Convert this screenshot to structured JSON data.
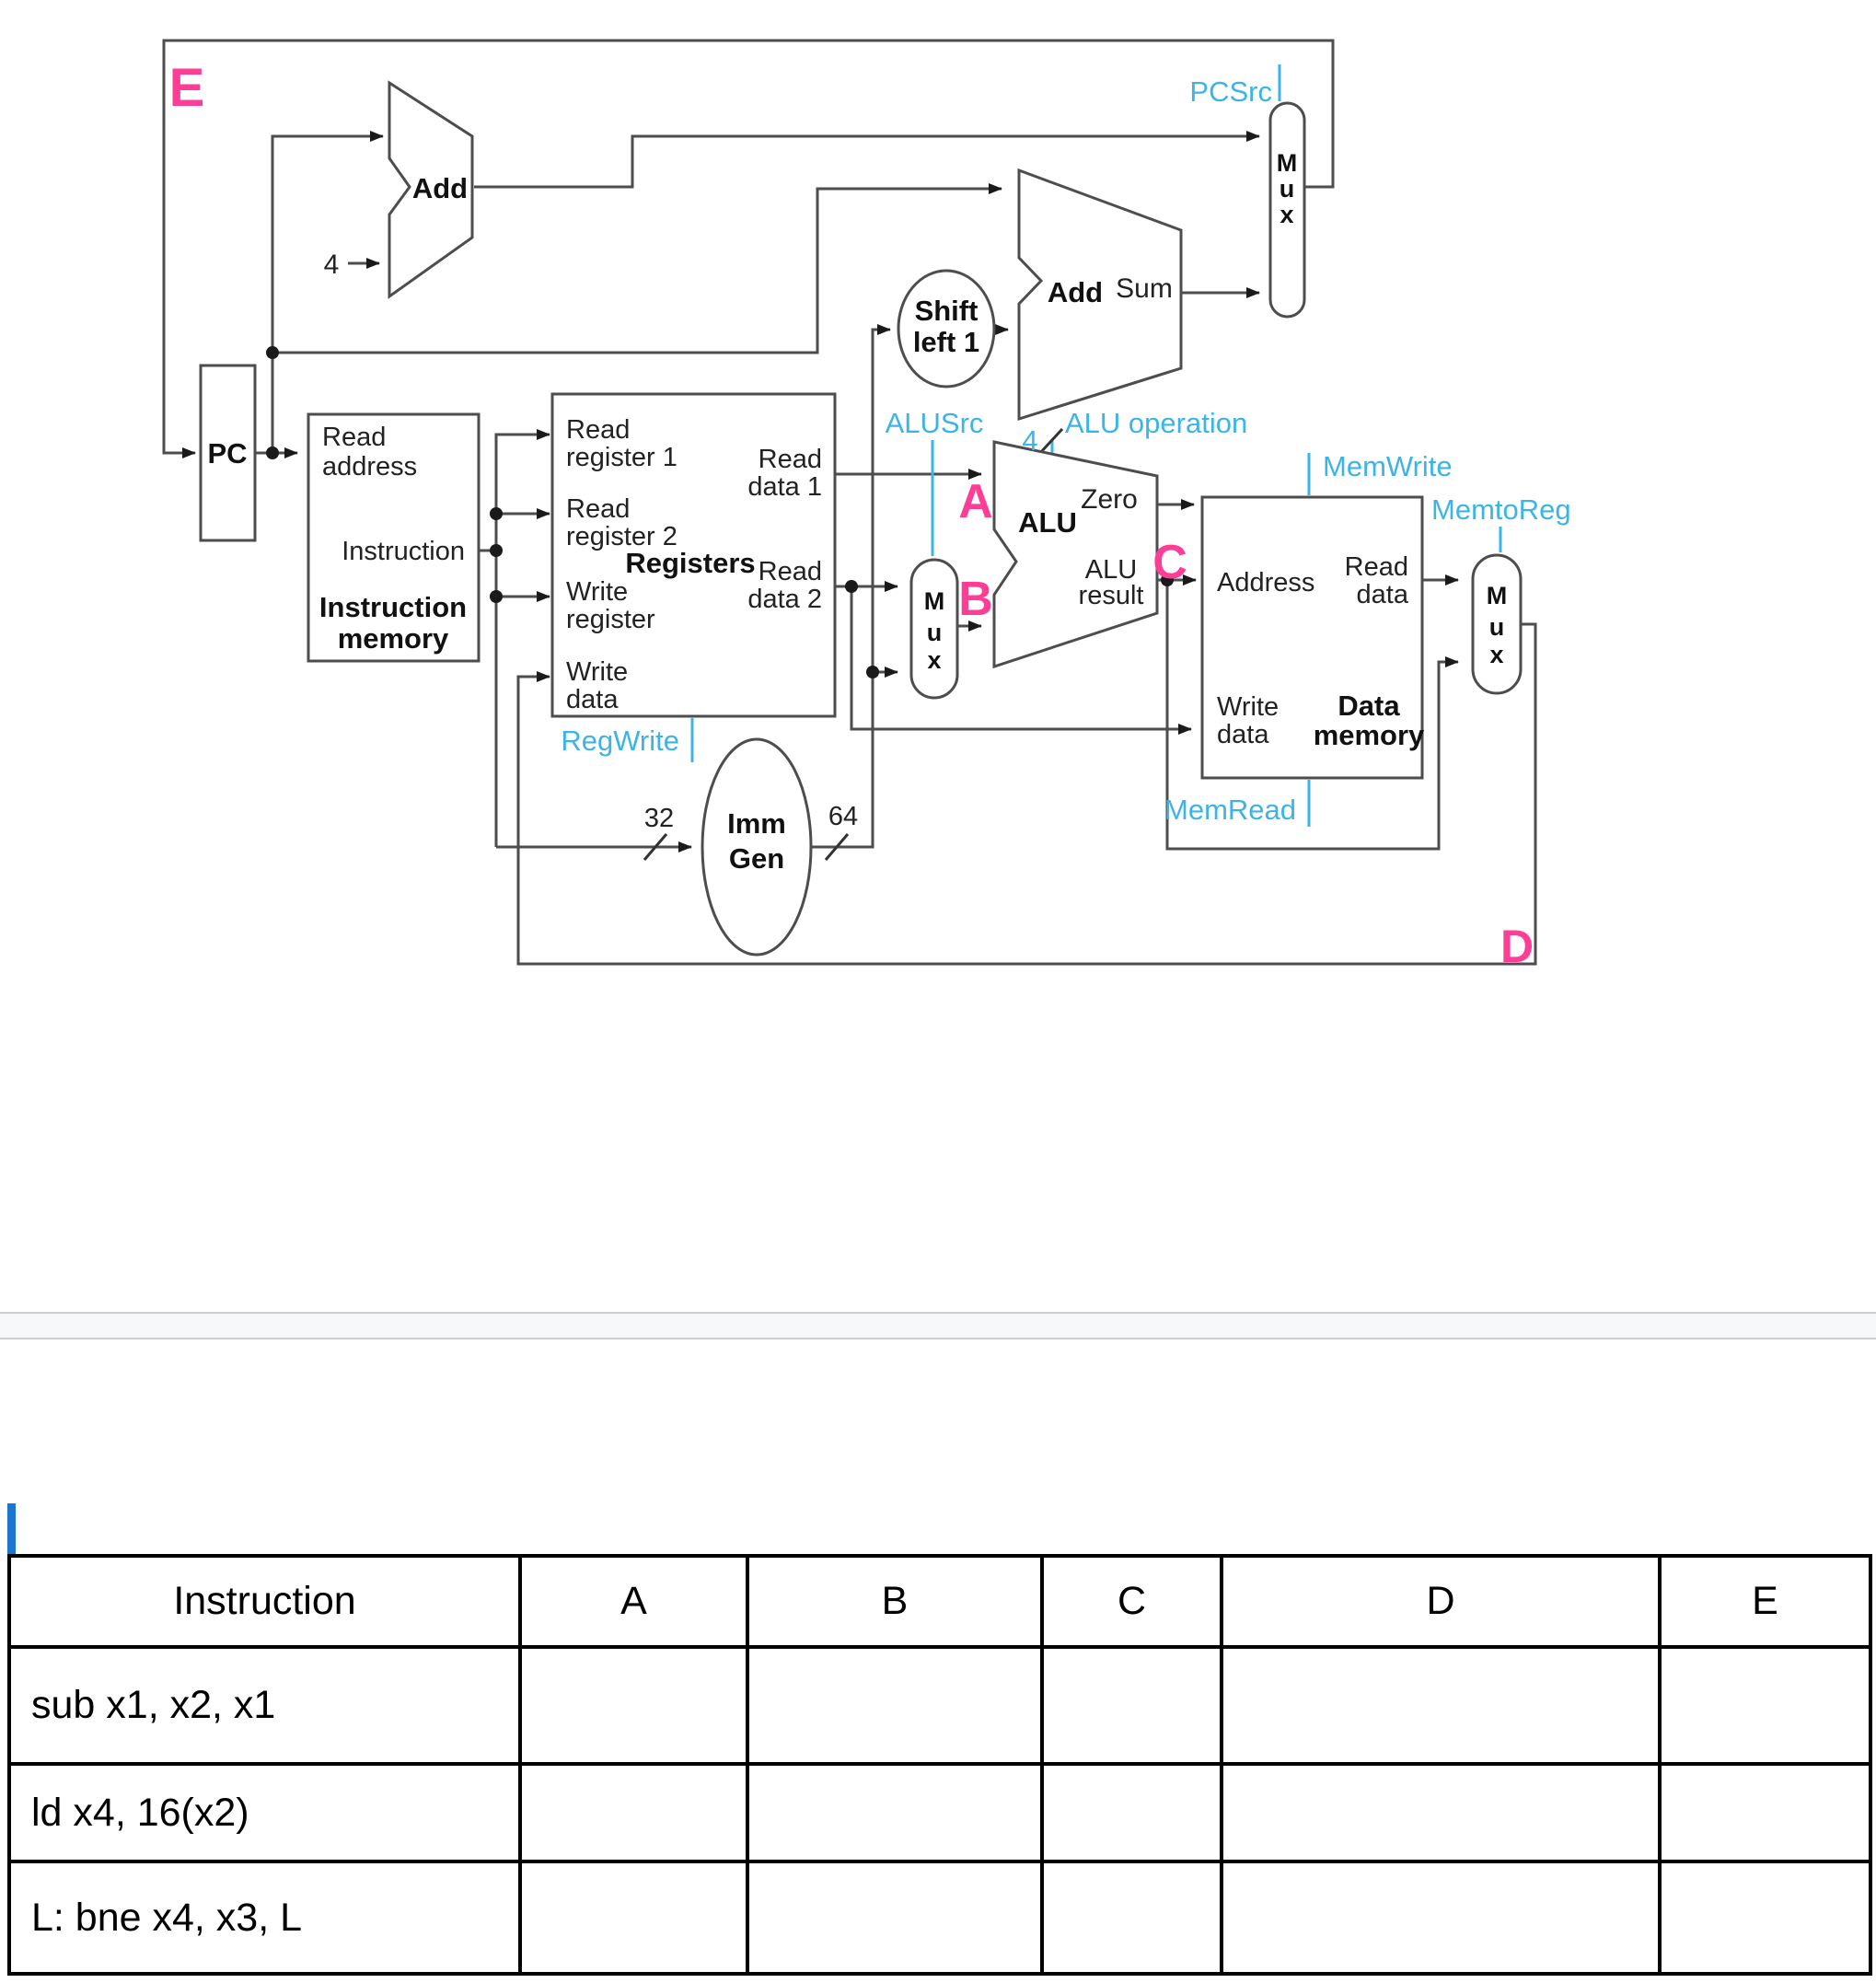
{
  "diagram": {
    "point_labels": {
      "e": "E",
      "a": "A",
      "b": "B",
      "c": "C",
      "d": "D"
    },
    "pc_label": "PC",
    "pc_increment": "4",
    "imem": {
      "read_address_1": "Read",
      "read_address_2": "address",
      "instruction_port": "Instruction",
      "title_1": "Instruction",
      "title_2": "memory"
    },
    "regfile": {
      "title": "Registers",
      "read_reg1_1": "Read",
      "read_reg1_2": "register 1",
      "read_reg2_1": "Read",
      "read_reg2_2": "register 2",
      "write_reg_1": "Write",
      "write_reg_2": "register",
      "write_data_1": "Write",
      "write_data_2": "data",
      "read_data1_1": "Read",
      "read_data1_2": "data 1",
      "read_data2_1": "Read",
      "read_data2_2": "data 2"
    },
    "adder1": {
      "label": "Add"
    },
    "adder2": {
      "label": "Add",
      "sum": "Sum"
    },
    "alu": {
      "label": "ALU",
      "zero": "Zero",
      "result_1": "ALU",
      "result_2": "result"
    },
    "shift": {
      "line1": "Shift",
      "line2": "left 1"
    },
    "immgen": {
      "line1": "Imm",
      "line2": "Gen",
      "in_width": "32",
      "out_width": "64"
    },
    "dmem": {
      "title_1": "Data",
      "title_2": "memory",
      "address": "Address",
      "read_data_1": "Read",
      "read_data_2": "data",
      "write_data_1": "Write",
      "write_data_2": "data"
    },
    "mux": {
      "m": "M",
      "u": "u",
      "x": "x"
    },
    "control": {
      "pcsrc": "PCSrc",
      "alusrc": "ALUSrc",
      "alu_op": "ALU operation",
      "alu_op_width": "4",
      "regwrite": "RegWrite",
      "memwrite": "MemWrite",
      "memtoreg": "MemtoReg",
      "memread": "MemRead"
    },
    "colors": {
      "control": "#3cb4e8",
      "highlight": "#fd3d96",
      "wire": "#4d4d4d"
    }
  },
  "table": {
    "headers": [
      "Instruction",
      "A",
      "B",
      "C",
      "D",
      "E"
    ],
    "rows": [
      {
        "instruction": "sub x1, x2, x1",
        "a": "",
        "b": "",
        "c": "",
        "d": "",
        "e": ""
      },
      {
        "instruction": "ld x4, 16(x2)",
        "a": "",
        "b": "",
        "c": "",
        "d": "",
        "e": ""
      },
      {
        "instruction": "L: bne x4, x3, L",
        "a": "",
        "b": "",
        "c": "",
        "d": "",
        "e": ""
      }
    ]
  }
}
